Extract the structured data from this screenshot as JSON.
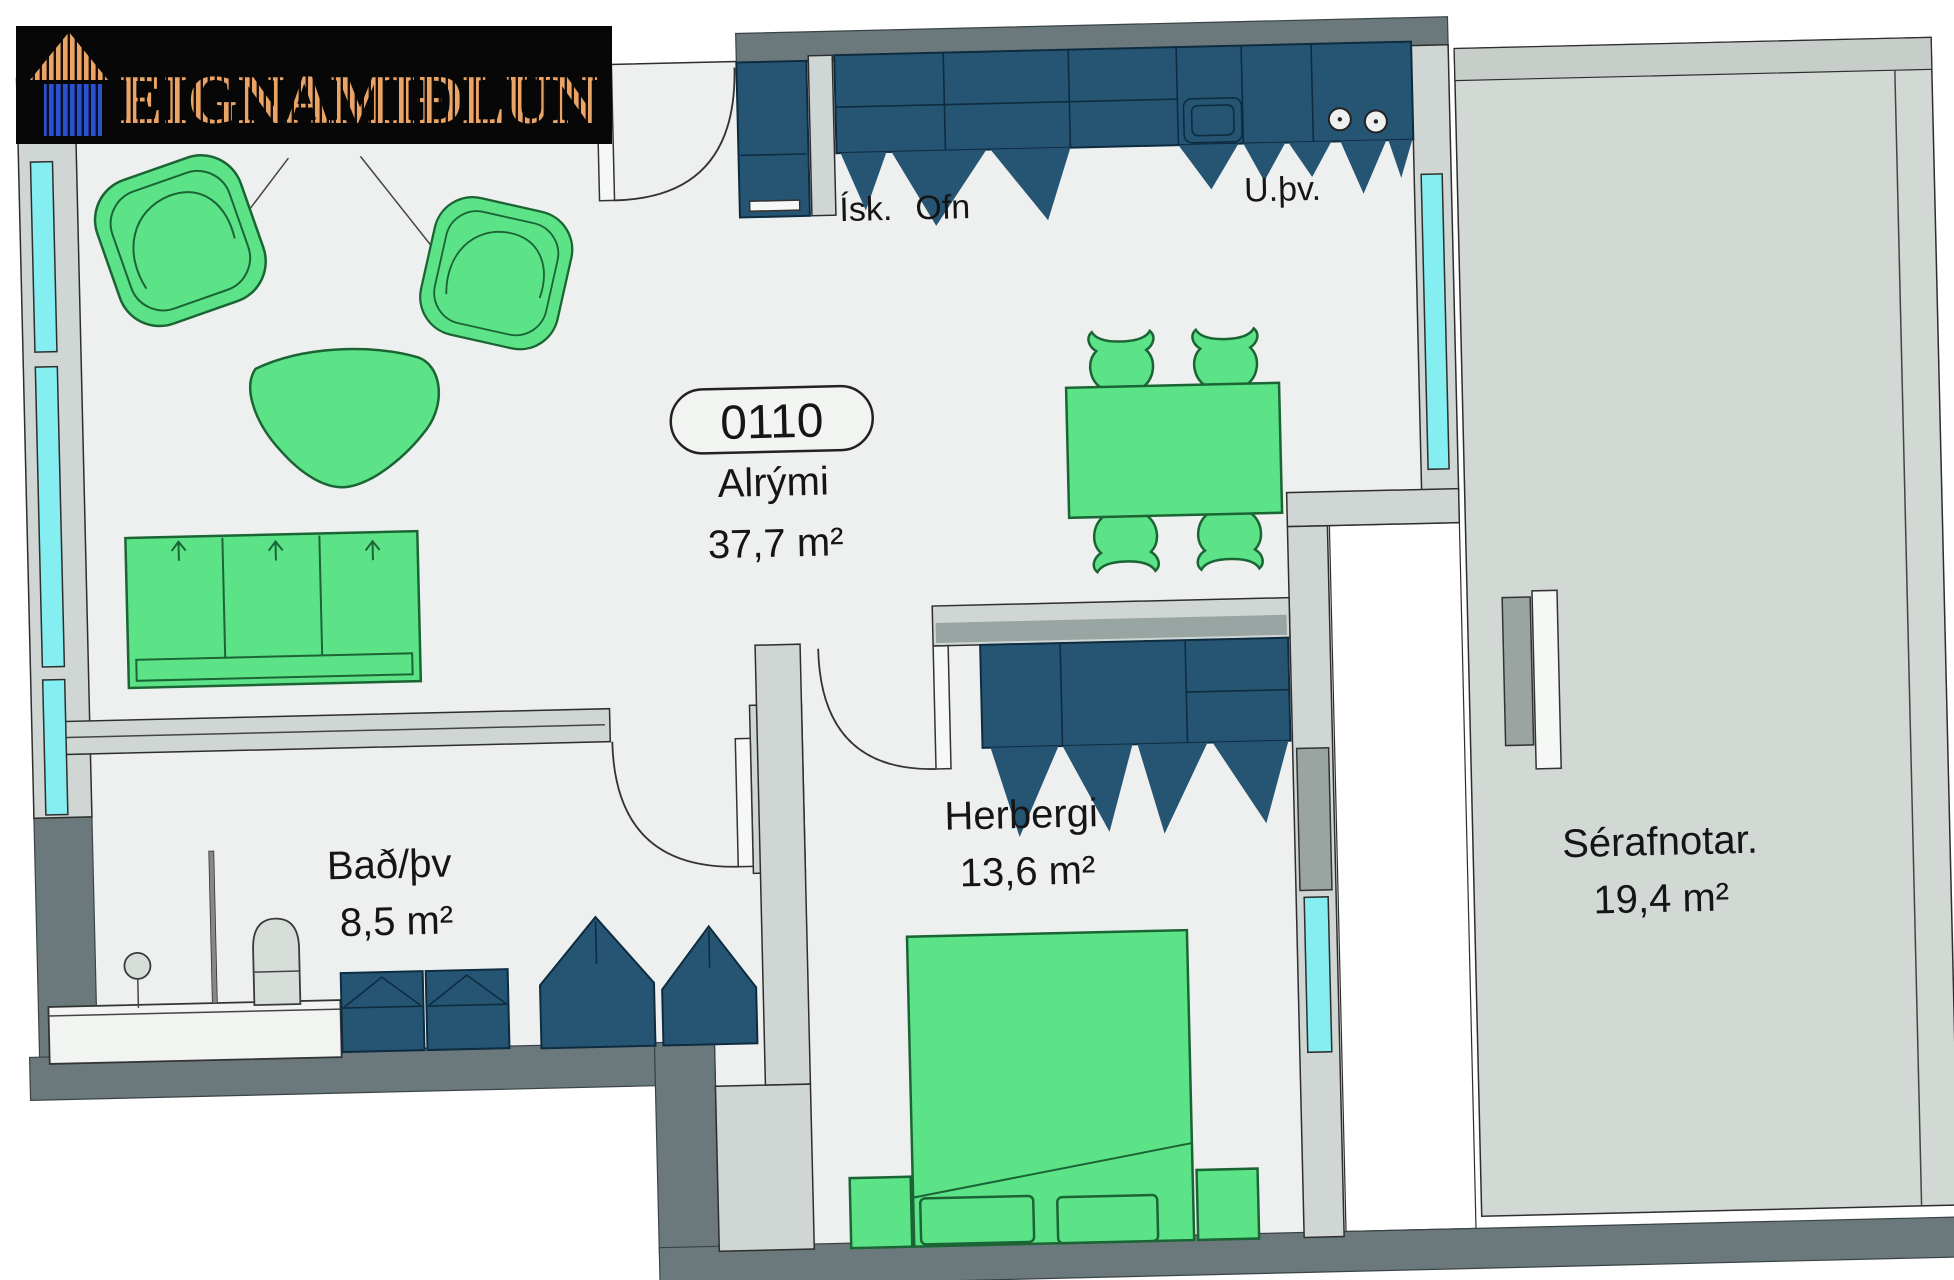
{
  "logo": {
    "text": "EIGNAMIÐLUN",
    "icon": "house-icon",
    "background": "#070707"
  },
  "unit_label": {
    "number": "0110"
  },
  "rooms": [
    {
      "id": "alrymi",
      "name": "Alrými",
      "area": "37,7 m²"
    },
    {
      "id": "herbergi",
      "name": "Herbergi",
      "area": "13,6 m²"
    },
    {
      "id": "bad-thv",
      "name": "Bað/þv",
      "area": "8,5 m²"
    },
    {
      "id": "serafnotar",
      "name": "Sérafnotar.",
      "area": "19,4 m²"
    }
  ],
  "appliances": [
    {
      "id": "fridge",
      "text": "Ísk."
    },
    {
      "id": "oven",
      "text": "Ofn"
    },
    {
      "id": "dishwasher",
      "text": "U.þv."
    }
  ],
  "colors": {
    "floor": "#edf0ee",
    "terrace_floor": "#d2d8d4",
    "wall_dark": "#6b797d",
    "wall_light": "#cfd6d3",
    "cabinet_teal": "#265573",
    "furniture_green": "#5ce388",
    "window_cyan": "#84eef1",
    "logo_orange": "#e8a567",
    "logo_blue": "#2a52cc"
  }
}
